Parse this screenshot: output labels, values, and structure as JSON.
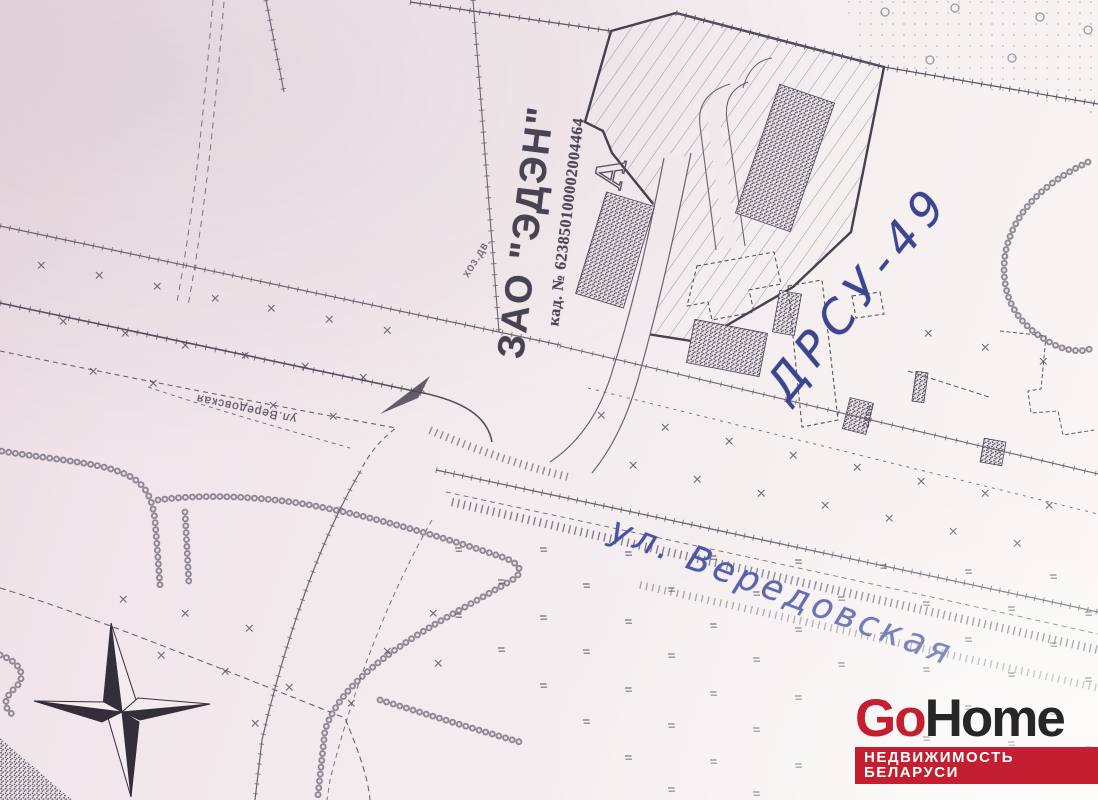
{
  "map": {
    "owner_label": "ЗАО \"ЭДЭН\"",
    "cadastral_label": "кад. № 623850100002004464",
    "marker_a": "А",
    "utility_yard": "хоз.дв.",
    "handwritten_plot": "ДРСУ-49",
    "street_handwritten": "ул. Вередовская",
    "street_printed": "ул.Вередовская",
    "building_code": "2866"
  },
  "branding": {
    "go": "Go",
    "home": "Home",
    "tagline": "НЕДВИЖИМОСТЬ БЕЛАРУСИ",
    "red": "#c41f30",
    "dark": "#262626"
  },
  "icons": {
    "compass": "four-point-compass-rose"
  },
  "colors": {
    "paper": "#f3ebee",
    "ink": "#675f6d",
    "bold_ink": "#4a4452",
    "pen_blue": "#3c458f"
  }
}
